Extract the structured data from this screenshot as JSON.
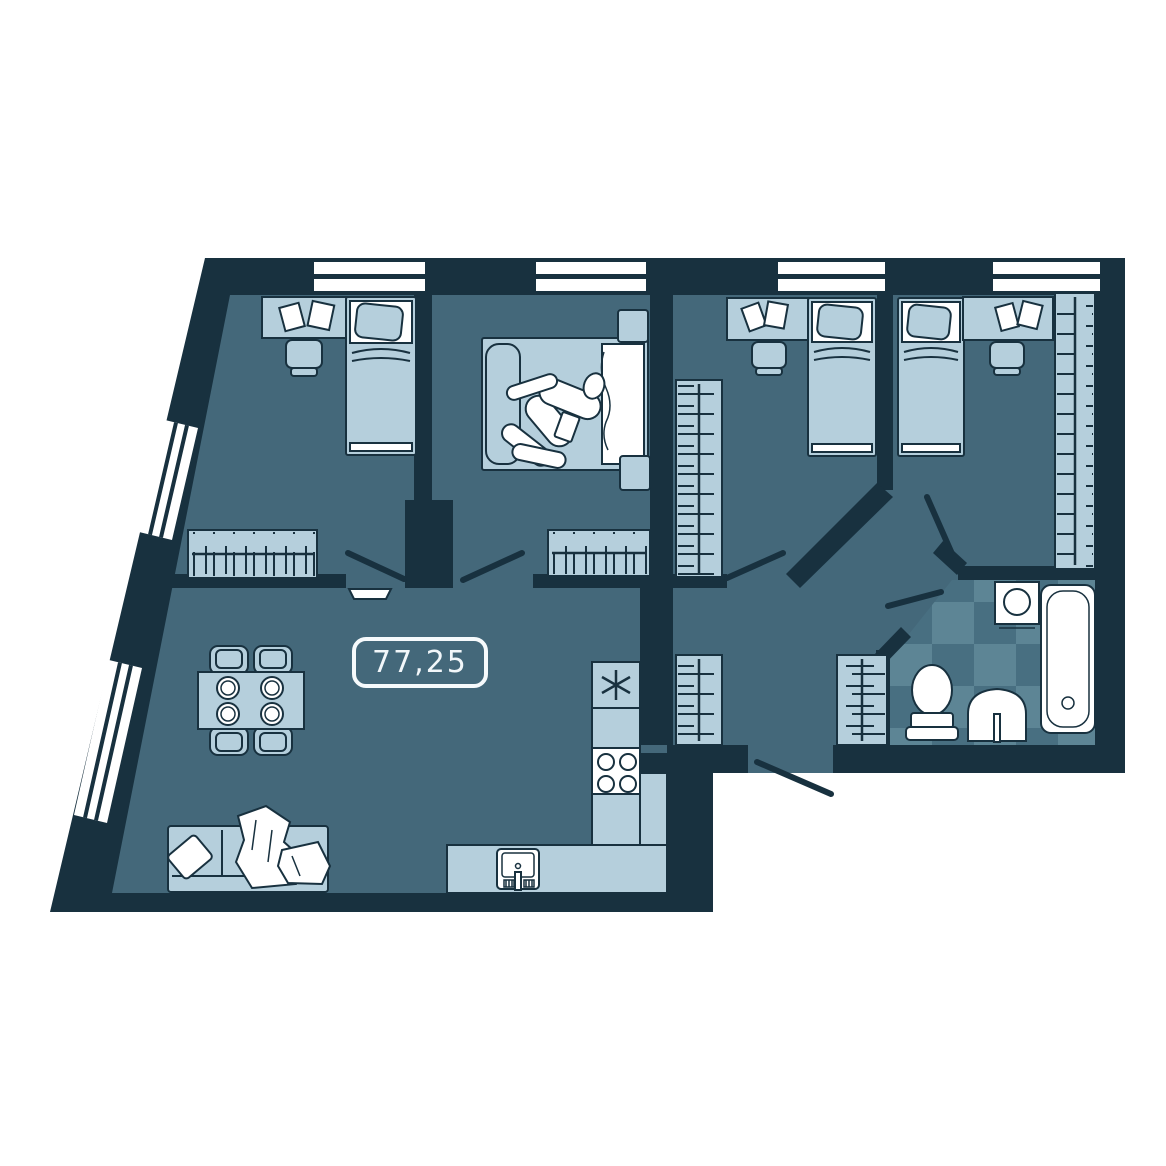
{
  "floor_plan": {
    "area_label": "77,25",
    "colors": {
      "wall": "#18313F",
      "floor": "#44687A",
      "furniture_light": "#B5CFDC",
      "fixture_white": "#FFFFFF",
      "tile_light": "#5D8595",
      "tile_dark": "#486F81",
      "label_border": "#F6FAFC",
      "label_text": "#F2F7FA"
    },
    "windows": {
      "top_wall_count": 4,
      "left_wall_count": 2
    },
    "rooms": [
      {
        "name": "bedroom-top-left",
        "furniture": [
          "desk",
          "desk-chair",
          "papers",
          "single-bed",
          "wardrobe",
          "door",
          "door-sill"
        ]
      },
      {
        "name": "bedroom-master",
        "furniture": [
          "double-bed",
          "sleeping-person",
          "nightstand-top",
          "nightstand-bottom",
          "wardrobe",
          "door"
        ]
      },
      {
        "name": "bedroom-child-left",
        "furniture": [
          "desk",
          "desk-chair",
          "papers",
          "single-bed",
          "tall-wardrobe",
          "door"
        ]
      },
      {
        "name": "bedroom-child-right",
        "furniture": [
          "single-bed",
          "desk",
          "desk-chair",
          "papers",
          "tall-wardrobe",
          "door"
        ]
      },
      {
        "name": "bathroom",
        "furniture": [
          "washing-machine",
          "bathtub",
          "toilet",
          "sink",
          "door",
          "checker-tiles"
        ]
      },
      {
        "name": "hallway",
        "furniture": [
          "closet-left",
          "closet-right",
          "entrance-door"
        ]
      },
      {
        "name": "kitchen-living-room",
        "furniture": [
          "fridge",
          "kitchen-counter",
          "stove",
          "kitchen-sink",
          "dining-table",
          "dining-chairs",
          "plates",
          "sofa",
          "sofa-pillows",
          "blanket"
        ]
      }
    ]
  }
}
